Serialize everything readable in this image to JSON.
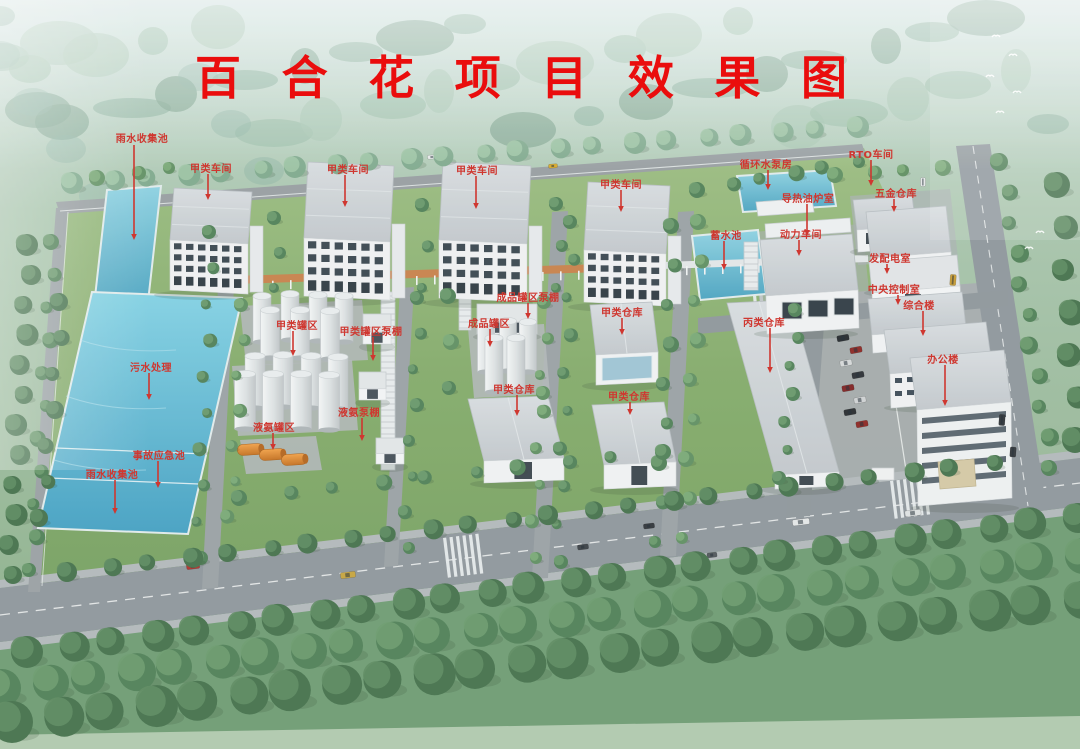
{
  "title": {
    "text": "百合花项目效果图",
    "color": "#ea0d0d"
  },
  "annotation": {
    "color": "#cf3730"
  },
  "labels": [
    {
      "id": "rain-pool-north",
      "text": "雨水收集池",
      "tx": 142,
      "ty": 130,
      "ax": 134,
      "ay1": 145,
      "ay2": 240
    },
    {
      "id": "workshop-a-1",
      "text": "甲类车间",
      "tx": 211,
      "ty": 160,
      "ax": 208,
      "ay1": 174,
      "ay2": 200
    },
    {
      "id": "workshop-a-2",
      "text": "甲类车间",
      "tx": 348,
      "ty": 161,
      "ax": 345,
      "ay1": 175,
      "ay2": 207
    },
    {
      "id": "workshop-a-3",
      "text": "甲类车间",
      "tx": 477,
      "ty": 162,
      "ax": 476,
      "ay1": 176,
      "ay2": 209
    },
    {
      "id": "workshop-a-4",
      "text": "甲类车间",
      "tx": 621,
      "ty": 176,
      "ax": 621,
      "ay1": 190,
      "ay2": 212
    },
    {
      "id": "circulating-water-pump-house",
      "text": "循环水泵房",
      "tx": 766,
      "ty": 156,
      "ax": 768,
      "ay1": 170,
      "ay2": 190
    },
    {
      "id": "rto-workshop",
      "text": "RTO车间",
      "tx": 871,
      "ty": 146,
      "ax": 871,
      "ay1": 160,
      "ay2": 186
    },
    {
      "id": "hardware-warehouse",
      "text": "五金仓库",
      "tx": 896,
      "ty": 185,
      "ax": 894,
      "ay1": 199,
      "ay2": 212
    },
    {
      "id": "thermal-oil-furnace-room",
      "text": "导热油炉室",
      "tx": 808,
      "ty": 190,
      "ax": 807,
      "ay1": 204,
      "ay2": 236
    },
    {
      "id": "storage-reservoir",
      "text": "蓄水池",
      "tx": 726,
      "ty": 227,
      "ax": 724,
      "ay1": 241,
      "ay2": 270
    },
    {
      "id": "power-workshop",
      "text": "动力车间",
      "tx": 801,
      "ty": 226,
      "ax": 799,
      "ay1": 240,
      "ay2": 256
    },
    {
      "id": "power-distribution-room",
      "text": "发配电室",
      "tx": 890,
      "ty": 250,
      "ax": 887,
      "ay1": 264,
      "ay2": 274
    },
    {
      "id": "central-control-room",
      "text": "中央控制室",
      "tx": 894,
      "ty": 281,
      "ax": 898,
      "ay1": 295,
      "ay2": 305
    },
    {
      "id": "comprehensive-building",
      "text": "综合楼",
      "tx": 919,
      "ty": 297,
      "ax": 923,
      "ay1": 311,
      "ay2": 336
    },
    {
      "id": "office-building",
      "text": "办公楼",
      "tx": 943,
      "ty": 351,
      "ax": 945,
      "ay1": 365,
      "ay2": 406
    },
    {
      "id": "tank-area-a",
      "text": "甲类罐区",
      "tx": 297,
      "ty": 317,
      "ax": 293,
      "ay1": 331,
      "ay2": 356
    },
    {
      "id": "tank-area-a-pump-shed",
      "text": "甲类罐区泵棚",
      "tx": 371,
      "ty": 323,
      "ax": 373,
      "ay1": 337,
      "ay2": 361
    },
    {
      "id": "product-tank-pump-shed",
      "text": "成品罐区泵棚",
      "tx": 528,
      "ty": 289,
      "ax": 528,
      "ay1": 303,
      "ay2": 319
    },
    {
      "id": "product-tank-area",
      "text": "成品罐区",
      "tx": 489,
      "ty": 315,
      "ax": 490,
      "ay1": 329,
      "ay2": 347
    },
    {
      "id": "warehouse-a-1",
      "text": "甲类仓库",
      "tx": 622,
      "ty": 304,
      "ax": 622,
      "ay1": 318,
      "ay2": 335
    },
    {
      "id": "warehouse-a-2",
      "text": "甲类仓库",
      "tx": 514,
      "ty": 381,
      "ax": 517,
      "ay1": 395,
      "ay2": 416
    },
    {
      "id": "warehouse-a-3",
      "text": "甲类仓库",
      "tx": 629,
      "ty": 388,
      "ax": 630,
      "ay1": 402,
      "ay2": 415
    },
    {
      "id": "warehouse-c",
      "text": "丙类仓库",
      "tx": 764,
      "ty": 314,
      "ax": 770,
      "ay1": 328,
      "ay2": 373
    },
    {
      "id": "ammonia-pump-shed",
      "text": "液氨泵棚",
      "tx": 359,
      "ty": 404,
      "ax": 362,
      "ay1": 418,
      "ay2": 441
    },
    {
      "id": "ammonia-tank-area",
      "text": "液氨罐区",
      "tx": 274,
      "ty": 419,
      "ax": 273,
      "ay1": 433,
      "ay2": 450
    },
    {
      "id": "sewage-treatment",
      "text": "污水处理",
      "tx": 151,
      "ty": 359,
      "ax": 149,
      "ay1": 373,
      "ay2": 400
    },
    {
      "id": "accident-emergency-pool",
      "text": "事故应急池",
      "tx": 159,
      "ty": 447,
      "ax": 158,
      "ay1": 461,
      "ay2": 488
    },
    {
      "id": "rain-pool-south",
      "text": "雨水收集池",
      "tx": 112,
      "ty": 466,
      "ax": 115,
      "ay1": 480,
      "ay2": 514
    }
  ]
}
